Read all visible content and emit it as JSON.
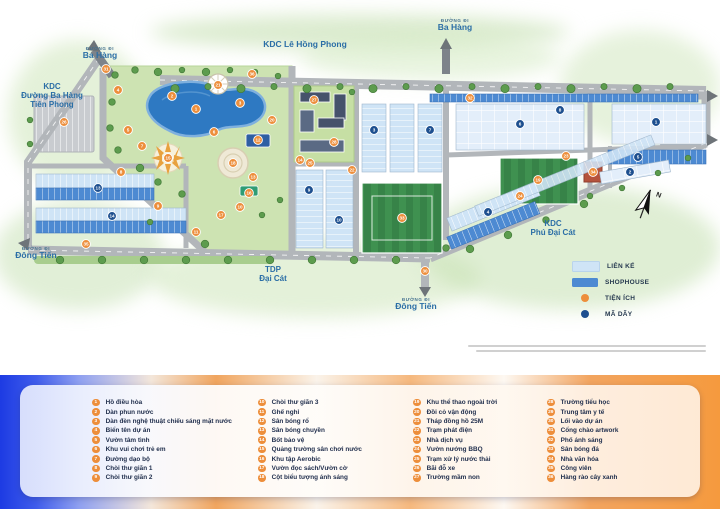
{
  "map": {
    "labels": {
      "kdc_le_hong_phong": "KDC Lê Hồng Phong",
      "road_prefix": "ĐƯỜNG ĐI",
      "ba_hang": "Ba Hàng",
      "kdc_tien_phong_l1": "KDC",
      "kdc_tien_phong_l2": "Đường Ba Hàng",
      "kdc_tien_phong_l3": "Tiên Phong",
      "dong_tien": "Đông Tiến",
      "tdp_l1": "TDP",
      "tdp_l2": "Đại Cát",
      "kdc_phu_dai_cat_l1": "KDC",
      "kdc_phu_dai_cat_l2": "Phú Đại Cát",
      "compass_n": "N"
    },
    "legend": {
      "lien_ke": "LIÊN KẾ",
      "shophouse": "SHOPHOUSE",
      "tien_ich": "TIỆN ÍCH",
      "ma_day": "MÃ DÃY"
    },
    "markers": {
      "utility": [
        [
          31,
          106,
          69
        ],
        [
          36,
          252,
          74
        ],
        [
          21,
          218,
          85
        ],
        [
          4,
          118,
          90
        ],
        [
          2,
          172,
          96
        ],
        [
          3,
          240,
          103
        ],
        [
          1,
          196,
          109
        ],
        [
          20,
          272,
          120
        ],
        [
          26,
          64,
          122
        ],
        [
          5,
          128,
          130
        ],
        [
          6,
          214,
          132
        ],
        [
          12,
          258,
          140
        ],
        [
          7,
          142,
          146
        ],
        [
          15,
          168,
          158
        ],
        [
          18,
          233,
          163
        ],
        [
          8,
          121,
          172
        ],
        [
          13,
          253,
          177
        ],
        [
          16,
          249,
          193
        ],
        [
          9,
          158,
          206
        ],
        [
          10,
          240,
          207
        ],
        [
          17,
          221,
          215
        ],
        [
          11,
          196,
          232
        ],
        [
          14,
          300,
          160
        ],
        [
          27,
          314,
          100
        ],
        [
          28,
          334,
          142
        ],
        [
          25,
          310,
          163
        ],
        [
          22,
          352,
          170
        ],
        [
          33,
          402,
          218
        ],
        [
          19,
          538,
          180
        ],
        [
          24,
          520,
          196
        ],
        [
          23,
          566,
          156
        ],
        [
          34,
          593,
          172
        ],
        [
          30,
          425,
          271
        ],
        [
          32,
          470,
          98
        ],
        [
          35,
          86,
          244
        ]
      ],
      "row": [
        [
          1,
          656,
          122
        ],
        [
          5,
          638,
          157
        ],
        [
          2,
          630,
          172
        ],
        [
          6,
          520,
          124
        ],
        [
          8,
          560,
          110
        ],
        [
          3,
          374,
          130
        ],
        [
          7,
          430,
          130
        ],
        [
          4,
          488,
          212
        ],
        [
          9,
          309,
          190
        ],
        [
          10,
          339,
          220
        ],
        [
          13,
          98,
          188
        ],
        [
          14,
          112,
          216
        ]
      ]
    }
  },
  "colors": {
    "lien_ke": "#CFE4F6",
    "shophouse": "#4D8AD2",
    "utility_orange": "#ED8E3B",
    "row_navy": "#1D4F8F",
    "label_blue": "#2B6EA6",
    "road_gray": "#B2B6BA",
    "park_green": "#CDE3B2",
    "lake_blue": "#2E79C2",
    "field_green": "#3F9150"
  },
  "amenities": {
    "columns": [
      [
        {
          "n": 1,
          "label": "Hồ điều hòa"
        },
        {
          "n": 2,
          "label": "Dàn phun nước"
        },
        {
          "n": 3,
          "label": "Dàn đèn nghệ thuật chiếu sáng mặt nước"
        },
        {
          "n": 4,
          "label": "Biển tên dự án"
        },
        {
          "n": 5,
          "label": "Vườn tâm tình"
        },
        {
          "n": 6,
          "label": "Khu vui chơi trẻ em"
        },
        {
          "n": 7,
          "label": "Đường dạo bộ"
        },
        {
          "n": 8,
          "label": "Chòi thư giãn 1"
        },
        {
          "n": 9,
          "label": "Chòi thư giãn 2"
        }
      ],
      [
        {
          "n": 10,
          "label": "Chòi thư giãn 3"
        },
        {
          "n": 11,
          "label": "Ghế nghỉ"
        },
        {
          "n": 12,
          "label": "Sân bóng rổ"
        },
        {
          "n": 13,
          "label": "Sân bóng chuyền"
        },
        {
          "n": 14,
          "label": "Bốt bảo vệ"
        },
        {
          "n": 15,
          "label": "Quảng trường sân chơi nước"
        },
        {
          "n": 16,
          "label": "Khu tập Aerobic"
        },
        {
          "n": 17,
          "label": "Vườn đọc sách/Vườn cờ"
        },
        {
          "n": 18,
          "label": "Cột biểu tượng ánh sáng"
        }
      ],
      [
        {
          "n": 19,
          "label": "Khu thể thao ngoài trời"
        },
        {
          "n": 20,
          "label": "Đồi cỏ vận động"
        },
        {
          "n": 21,
          "label": "Tháp đồng hồ 25M"
        },
        {
          "n": 22,
          "label": "Trạm phát điện"
        },
        {
          "n": 23,
          "label": "Nhà dịch vụ"
        },
        {
          "n": 24,
          "label": "Vườn nướng BBQ"
        },
        {
          "n": 25,
          "label": "Trạm xử lý nước thải"
        },
        {
          "n": 26,
          "label": "Bãi đỗ xe"
        },
        {
          "n": 27,
          "label": "Trường mầm non"
        }
      ],
      [
        {
          "n": 28,
          "label": "Trường tiểu học"
        },
        {
          "n": 29,
          "label": "Trung tâm y tế"
        },
        {
          "n": 30,
          "label": "Lối vào dự án"
        },
        {
          "n": 31,
          "label": "Cổng chào artwork"
        },
        {
          "n": 32,
          "label": "Phố ánh sáng"
        },
        {
          "n": 33,
          "label": "Sân bóng đá"
        },
        {
          "n": 34,
          "label": "Nhà văn hóa"
        },
        {
          "n": 35,
          "label": "Công viên"
        },
        {
          "n": 36,
          "label": "Hàng rào cây xanh"
        }
      ]
    ]
  }
}
